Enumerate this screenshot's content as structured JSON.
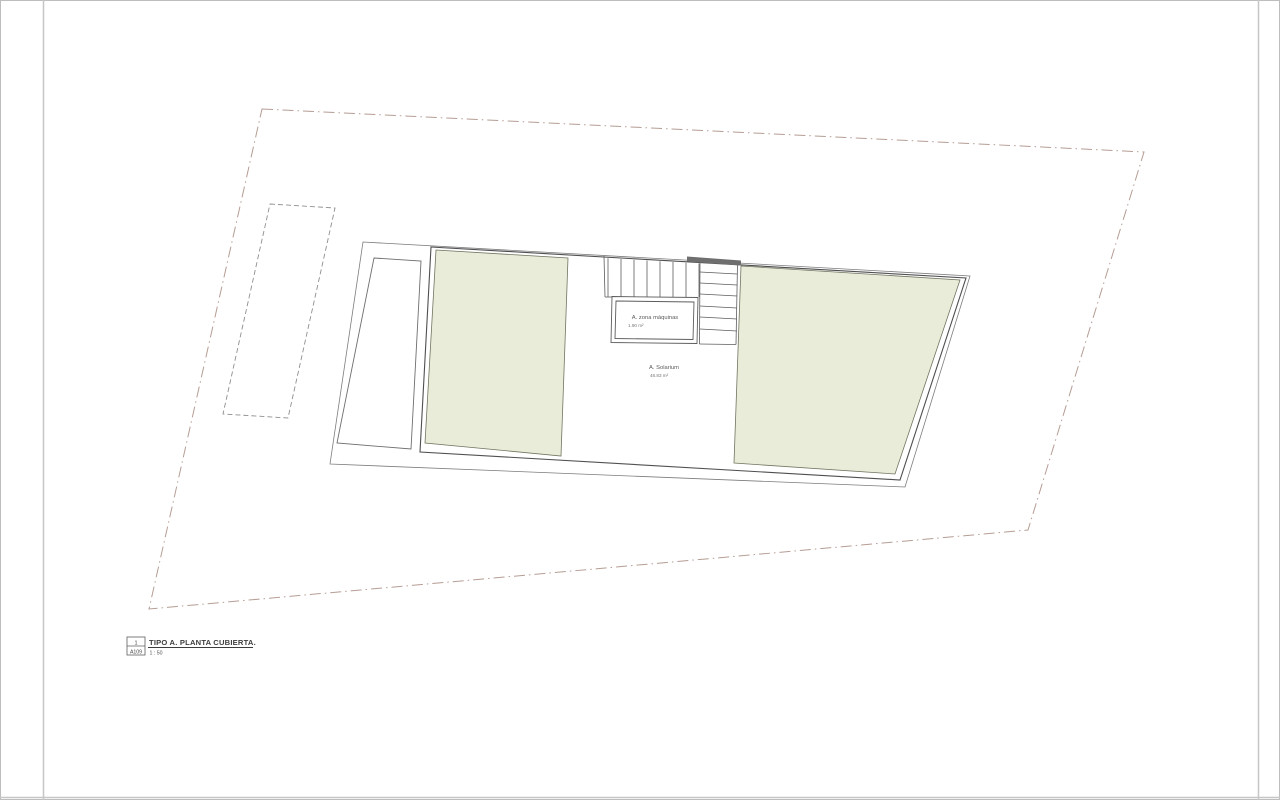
{
  "page": {
    "background": "#ffffff",
    "frame_color": "#c6c6c6"
  },
  "drawing": {
    "rooms": [
      {
        "id": "zona-maquinas",
        "label": "A. zona máquinas",
        "area": "1.90 m²"
      },
      {
        "id": "solarium",
        "label": "A. Solarium",
        "area": "48.83 m²"
      }
    ],
    "colors": {
      "terrace_green": "#e9ecd8",
      "site_boundary": "#b59d94",
      "stair_bar": "#6f6f6f"
    }
  },
  "title_block": {
    "detail_number": "1",
    "sheet_number": "A109",
    "title": "TIPO A. PLANTA CUBIERTA.",
    "scale": "1 : 50"
  }
}
